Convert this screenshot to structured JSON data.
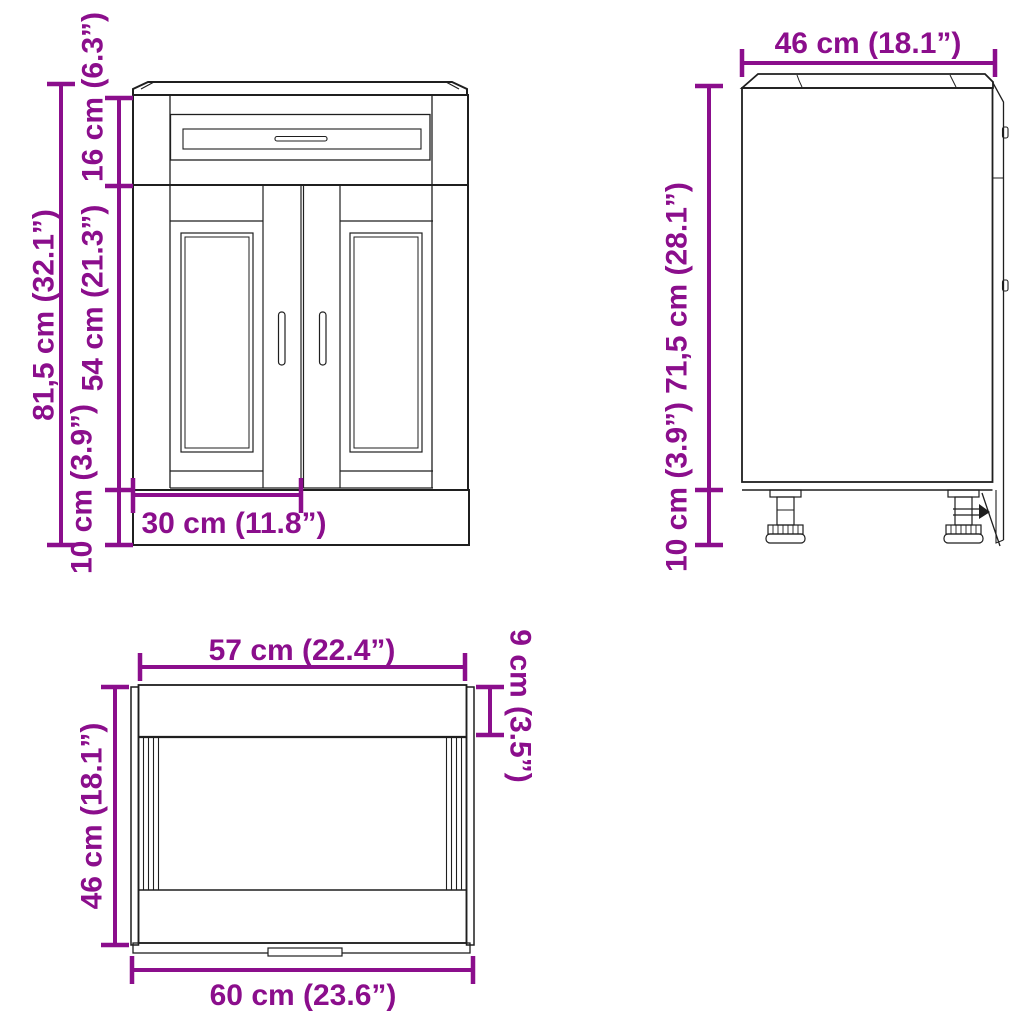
{
  "title": "Kitchen base cabinet dimension diagram",
  "colors": {
    "dimension_accent": "#8B0E8C",
    "drawing_line": "#1f1f1f",
    "background": "#ffffff"
  },
  "views": {
    "front": {
      "name": "front-view",
      "height_total": "81,5 cm (32.1”)",
      "height_drawer": "16 cm (6.3”)",
      "height_door": "54 cm (21.3”)",
      "height_plinth": "10 cm (3.9”)",
      "width_door": "30 cm (11.8”)"
    },
    "side": {
      "name": "side-view",
      "depth": "46 cm (18.1”)",
      "height_body": "71,5 cm (28.1”)",
      "height_feet": "10 cm (3.9”)"
    },
    "top": {
      "name": "top-view",
      "width_inner": "57 cm (22.4”)",
      "depth_front": "9 cm (3.5”)",
      "depth_total": "46 cm (18.1”)",
      "width_total": "60 cm (23.6”)"
    }
  }
}
